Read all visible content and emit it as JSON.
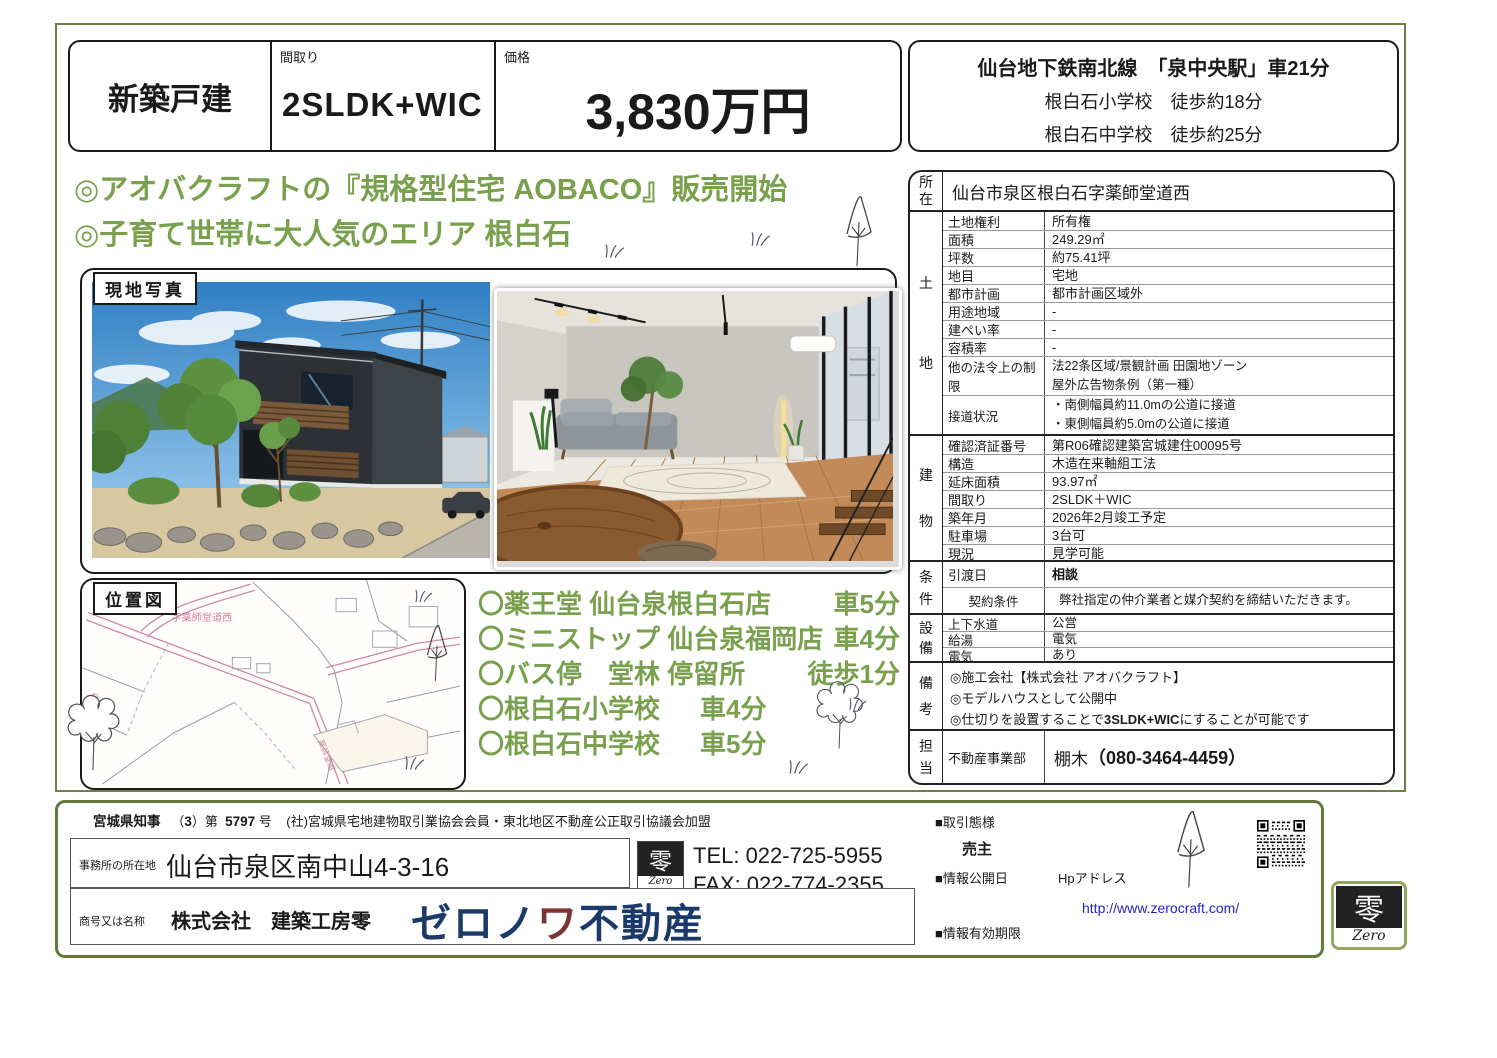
{
  "colors": {
    "green": "#79a04c",
    "olive_border": "#6f7f46",
    "footer_border": "#637a3c",
    "brand_navy": "#1b3a68",
    "brand_red": "#7d3434",
    "link_blue": "#2323cc"
  },
  "header": {
    "category": "新築戸建",
    "madori_label": "間取り",
    "madori_value": "2SLDK+WIC",
    "price_label": "価格",
    "price_value": "3,830万円"
  },
  "access": {
    "line1": "仙台地下鉄南北線　「泉中央駅」車21分",
    "line2": "根白石小学校　徒歩約18分",
    "line3": "根白石中学校　徒歩約25分"
  },
  "headlines": {
    "line1": "◎アオバクラフトの『規格型住宅 AOBACO』販売開始",
    "line2": "◎子育て世帯に大人気のエリア 根白石"
  },
  "labels": {
    "site_photo": "現地写真",
    "location_map": "位置図"
  },
  "map": {
    "area_text": "字薬師堂道西"
  },
  "nearby": [
    {
      "name": "〇薬王堂 仙台泉根白石店",
      "time": "車5分"
    },
    {
      "name": "〇ミニストップ 仙台泉福岡店",
      "time": "車4分"
    },
    {
      "name": "〇バス停　堂林 停留所",
      "time": "徒歩1分"
    },
    {
      "name": "〇根白石小学校",
      "time": "車4分"
    },
    {
      "name": "〇根白石中学校",
      "time": "車5分"
    }
  ],
  "spec": {
    "location_label": "所在",
    "location_value": "仙台市泉区根白石字薬師堂道西",
    "groups": [
      {
        "label": "土地",
        "rows": [
          {
            "k": "土地権利",
            "v": "所有権"
          },
          {
            "k": "面積",
            "v": "249.29㎡"
          },
          {
            "k": "坪数",
            "v": "約75.41坪"
          },
          {
            "k": "地目",
            "v": "宅地"
          },
          {
            "k": "都市計画",
            "v": "都市計画区域外"
          },
          {
            "k": "用途地域",
            "v": "-"
          },
          {
            "k": "建ぺい率",
            "v": "-"
          },
          {
            "k": "容積率",
            "v": "-"
          },
          {
            "k": "他の法令上の制限",
            "v": "法22条区域/景観計画 田園地ゾーン\n屋外広告物条例（第一種）"
          },
          {
            "k": "接道状況",
            "v": "・南側幅員約11.0mの公道に接道\n・東側幅員約5.0mの公道に接道"
          }
        ]
      },
      {
        "label": "建物",
        "rows": [
          {
            "k": "確認済証番号",
            "v": "第R06確認建築宮城建住00095号"
          },
          {
            "k": "構造",
            "v": "木造在来軸組工法"
          },
          {
            "k": "延床面積",
            "v": "93.97㎡"
          },
          {
            "k": "間取り",
            "v": "2SLDK＋WIC"
          },
          {
            "k": "築年月",
            "v": "2026年2月竣工予定"
          },
          {
            "k": "駐車場",
            "v": "3台可"
          },
          {
            "k": "現況",
            "v": "見学可能"
          }
        ]
      },
      {
        "label": "条件",
        "rows": [
          {
            "k": "引渡日",
            "v": "相談"
          },
          {
            "k": "契約条件",
            "v": "弊社指定の仲介業者と媒介契約を締結いただきます。"
          }
        ]
      },
      {
        "label": "設備",
        "rows": [
          {
            "k": "上下水道",
            "v": "公営"
          },
          {
            "k": "給湯",
            "v": "電気"
          },
          {
            "k": "電気",
            "v": "あり"
          }
        ]
      },
      {
        "label": "備考",
        "lines": [
          "◎施工会社【株式会社 アオバクラフト】",
          "◎モデルハウスとして公開中"
        ],
        "line3_pre": "◎仕切りを設置することで",
        "line3_bold": "3SLDK+WIC",
        "line3_post": "にすることが可能です"
      },
      {
        "label": "担当",
        "dept": "不動産事業部",
        "name": "棚木",
        "phone": "（080-3464-4459）"
      }
    ]
  },
  "footer": {
    "license": {
      "authority": "宮城県知事",
      "bracket_open": "（",
      "renewal": "3",
      "bracket_close": "）第",
      "number": "5797",
      "suffix": "号",
      "membership": "(社)宮城県宅地建物取引業協会会員・東北地区不動産公正取引協議会加盟"
    },
    "office_label": "事務所の所在地",
    "office_value": "仙台市泉区南中山4-3-16",
    "tel": "TEL: 022-725-5955",
    "fax": "FAX: 022-774-2355",
    "company_label": "商号又は名称",
    "company_name": "株式会社　建築工房零",
    "brand1": "ゼロノ",
    "brand2": "ワ",
    "brand3": "不動産",
    "deal_type_label": "■取引態様",
    "deal_type_value": "売主",
    "info_date_label": "■情報公開日",
    "hp_label": "Hpアドレス",
    "url": "http://www.zerocraft.com/",
    "expiry_label": "■情報有効期限"
  },
  "logo": {
    "zero_char": "零",
    "zero_latin": "Zero"
  }
}
